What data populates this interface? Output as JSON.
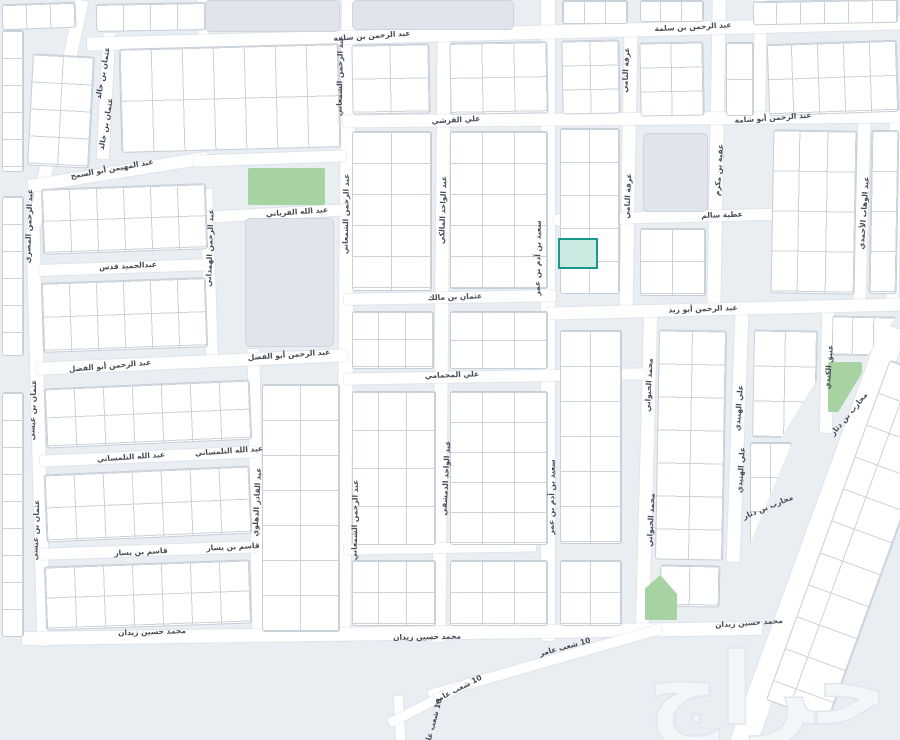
{
  "colors": {
    "background": "#e9eef3",
    "road": "#ffffff",
    "block_fill": "#ffffff",
    "block_border": "#c6ced6",
    "parcel_line": "#ccd3da",
    "landmark": "#dfe5ea",
    "park": "#a6d3a1",
    "highlight_fill": "#cdeae2",
    "highlight_border": "#18998c",
    "label": "#454b53",
    "watermark": "#f3f6f9"
  },
  "watermark": {
    "text": "حراج"
  },
  "highlight_parcel": {
    "x": 558,
    "y": 238,
    "w": 36,
    "h": 27
  },
  "street_labels": [
    {
      "text": "عبد الرحمن بن سلمة",
      "x": 372,
      "y": 36,
      "rot": -4
    },
    {
      "text": "عبد الرحمن بن سلمة",
      "x": 693,
      "y": 27,
      "rot": -3
    },
    {
      "text": "علي القرشي",
      "x": 456,
      "y": 120,
      "rot": -3
    },
    {
      "text": "عبد الرحمن أبو شامة",
      "x": 773,
      "y": 118,
      "rot": -4
    },
    {
      "text": "عبد المهيمن أبو السمح",
      "x": 112,
      "y": 169,
      "rot": -10
    },
    {
      "text": "عبد الله الفرياني",
      "x": 297,
      "y": 212,
      "rot": -4
    },
    {
      "text": "عطية سالم",
      "x": 722,
      "y": 215,
      "rot": -2
    },
    {
      "text": "عبدالحميد قدس",
      "x": 128,
      "y": 266,
      "rot": -3
    },
    {
      "text": "عثمان بن مالك",
      "x": 455,
      "y": 297,
      "rot": -2
    },
    {
      "text": "عبد الرحمن أبو زيد",
      "x": 703,
      "y": 309,
      "rot": -2
    },
    {
      "text": "عبد الرحمن أبو الفضل",
      "x": 110,
      "y": 366,
      "rot": -5
    },
    {
      "text": "عبد الرحمن أبو الفضل",
      "x": 289,
      "y": 355,
      "rot": -4
    },
    {
      "text": "علي المحمامي",
      "x": 452,
      "y": 375,
      "rot": -2
    },
    {
      "text": "عبد الله التلمساني",
      "x": 131,
      "y": 457,
      "rot": -4
    },
    {
      "text": "عبد الله التلمساني",
      "x": 229,
      "y": 451,
      "rot": -4
    },
    {
      "text": "قاسم بن يسار",
      "x": 141,
      "y": 552,
      "rot": -3
    },
    {
      "text": "قاسم بن يسار",
      "x": 233,
      "y": 547,
      "rot": -3
    },
    {
      "text": "محمد حسين زيدان",
      "x": 152,
      "y": 632,
      "rot": -2
    },
    {
      "text": "محمد حسين زيدان",
      "x": 427,
      "y": 637,
      "rot": -1
    },
    {
      "text": "محمد حسين زيدان",
      "x": 749,
      "y": 623,
      "rot": -4
    },
    {
      "text": "10 شعب عامر",
      "x": 565,
      "y": 647,
      "rot": -15
    },
    {
      "text": "10 شعب عامر",
      "x": 458,
      "y": 689,
      "rot": -27
    },
    {
      "text": "10 شعب عامر",
      "x": 433,
      "y": 724,
      "rot": -75
    },
    {
      "text": "عثمان بن خالد",
      "x": 103,
      "y": 73,
      "rot": -80
    },
    {
      "text": "عثمان بن خالد",
      "x": 106,
      "y": 124,
      "rot": -80
    },
    {
      "text": "عبد الرحمن المصري",
      "x": 29,
      "y": 226,
      "rot": -88
    },
    {
      "text": "عثمان بن عيسى",
      "x": 33,
      "y": 410,
      "rot": -88
    },
    {
      "text": "عثمان بن عيسى",
      "x": 36,
      "y": 530,
      "rot": -88
    },
    {
      "text": "عبد الرحمن الهمداني",
      "x": 210,
      "y": 248,
      "rot": -88
    },
    {
      "text": "عبد القادر الدهلوي",
      "x": 257,
      "y": 502,
      "rot": -87
    },
    {
      "text": "عبد الرحمن الشمعاني",
      "x": 340,
      "y": 76,
      "rot": -89
    },
    {
      "text": "عبد الرحمن الشمعاني",
      "x": 346,
      "y": 214,
      "rot": -89
    },
    {
      "text": "عبد الرحمن الشمعاني",
      "x": 355,
      "y": 520,
      "rot": -89
    },
    {
      "text": "عبد الواحد المالكي",
      "x": 443,
      "y": 210,
      "rot": -88
    },
    {
      "text": "عبد الواحد الدمشقي",
      "x": 446,
      "y": 478,
      "rot": -87
    },
    {
      "text": "سعيد بن آدم بن عمر",
      "x": 538,
      "y": 258,
      "rot": -89
    },
    {
      "text": "سعيد بن آدم بن عمر",
      "x": 552,
      "y": 497,
      "rot": -89
    },
    {
      "text": "عرفة النامي",
      "x": 626,
      "y": 70,
      "rot": -87
    },
    {
      "text": "عرفة النامي",
      "x": 628,
      "y": 196,
      "rot": -87
    },
    {
      "text": "عقبة بن مكرم",
      "x": 719,
      "y": 170,
      "rot": -86
    },
    {
      "text": "محمد الحبواني",
      "x": 649,
      "y": 385,
      "rot": -87
    },
    {
      "text": "محمد الحبواني",
      "x": 651,
      "y": 520,
      "rot": -87
    },
    {
      "text": "علي الهنيدي",
      "x": 739,
      "y": 408,
      "rot": -86
    },
    {
      "text": "علي الهنيدي",
      "x": 741,
      "y": 470,
      "rot": -86
    },
    {
      "text": "عتيق الكندي",
      "x": 829,
      "y": 367,
      "rot": -86
    },
    {
      "text": "عبد الوهاب الأحمدي",
      "x": 864,
      "y": 213,
      "rot": -86
    },
    {
      "text": "محارب بن دثار",
      "x": 849,
      "y": 414,
      "rot": -50
    },
    {
      "text": "محارب بن دثار",
      "x": 768,
      "y": 507,
      "rot": -22
    }
  ],
  "geometry": {
    "roads": [
      {
        "x": 57,
        "y": 115,
        "w": 13,
        "h": 235,
        "rot": 12
      },
      {
        "x": 38,
        "y": 437,
        "w": 13,
        "h": 418,
        "rot": -1.5
      },
      {
        "x": 106,
        "y": 96,
        "w": 12,
        "h": 126,
        "rot": 3
      },
      {
        "x": 203,
        "y": 17,
        "w": 10,
        "h": 38,
        "rot": -2
      },
      {
        "x": 209,
        "y": 272,
        "w": 12,
        "h": 167,
        "rot": -2
      },
      {
        "x": 256,
        "y": 495,
        "w": 12,
        "h": 292,
        "rot": -1
      },
      {
        "x": 346,
        "y": 320,
        "w": 14,
        "h": 642,
        "rot": 0.5
      },
      {
        "x": 441,
        "y": 336,
        "w": 13,
        "h": 612,
        "rot": 0.5
      },
      {
        "x": 548,
        "y": 320,
        "w": 14,
        "h": 642,
        "rot": 0
      },
      {
        "x": 628,
        "y": 170,
        "w": 13,
        "h": 287,
        "rot": 1
      },
      {
        "x": 646,
        "y": 472,
        "w": 13,
        "h": 324,
        "rot": 1.5
      },
      {
        "x": 716,
        "y": 157,
        "w": 13,
        "h": 315,
        "rot": 1
      },
      {
        "x": 737,
        "y": 436,
        "w": 13,
        "h": 252,
        "rot": 2
      },
      {
        "x": 760,
        "y": 60,
        "w": 12,
        "h": 122,
        "rot": 1
      },
      {
        "x": 827,
        "y": 372,
        "w": 12,
        "h": 122,
        "rot": 1
      },
      {
        "x": 862,
        "y": 210,
        "w": 12,
        "h": 186,
        "rot": 1.5
      },
      {
        "x": 894,
        "y": 215,
        "w": 12,
        "h": 192,
        "rot": 1
      },
      {
        "x": 399,
        "y": 719,
        "w": 9,
        "h": 46,
        "rot": -3
      },
      {
        "x": 495,
        "y": 33,
        "w": 816,
        "h": 13,
        "rot": -1.5
      },
      {
        "x": 622,
        "y": 119,
        "w": 558,
        "h": 12,
        "rot": -0.5
      },
      {
        "x": 118,
        "y": 172,
        "w": 182,
        "h": 12,
        "rot": -9
      },
      {
        "x": 270,
        "y": 158,
        "w": 152,
        "h": 11,
        "rot": -2
      },
      {
        "x": 276,
        "y": 213,
        "w": 142,
        "h": 11,
        "rot": -3
      },
      {
        "x": 685,
        "y": 216,
        "w": 262,
        "h": 11,
        "rot": -1.5
      },
      {
        "x": 125,
        "y": 267,
        "w": 172,
        "h": 11,
        "rot": -2
      },
      {
        "x": 450,
        "y": 297,
        "w": 212,
        "h": 11,
        "rot": -1
      },
      {
        "x": 725,
        "y": 309,
        "w": 357,
        "h": 12,
        "rot": -1.5
      },
      {
        "x": 192,
        "y": 362,
        "w": 312,
        "h": 12,
        "rot": -2.5
      },
      {
        "x": 495,
        "y": 376,
        "w": 302,
        "h": 11,
        "rot": -1
      },
      {
        "x": 148,
        "y": 456,
        "w": 217,
        "h": 11,
        "rot": -2.5
      },
      {
        "x": 148,
        "y": 550,
        "w": 217,
        "h": 11,
        "rot": -2
      },
      {
        "x": 440,
        "y": 548,
        "w": 192,
        "h": 10,
        "rot": -1
      },
      {
        "x": 392,
        "y": 633,
        "w": 740,
        "h": 13,
        "rot": -0.8
      },
      {
        "x": 817,
        "y": 540,
        "w": 26,
        "h": 452,
        "rot": 20
      },
      {
        "x": 545,
        "y": 662,
        "w": 242,
        "h": 10,
        "rot": -16
      },
      {
        "x": 430,
        "y": 702,
        "w": 92,
        "h": 9,
        "rot": -27
      }
    ],
    "blocks": [
      {
        "x": 96,
        "y": 3,
        "w": 108,
        "h": 26,
        "cw": 27,
        "ch": 30,
        "rot": -1
      },
      {
        "x": 2,
        "y": 3,
        "w": 72,
        "h": 24,
        "cw": 24,
        "ch": 26,
        "rot": -2
      },
      {
        "x": 2,
        "y": 30,
        "w": 20,
        "h": 140,
        "cw": 99,
        "ch": 27
      },
      {
        "x": 2,
        "y": 196,
        "w": 20,
        "h": 158,
        "cw": 99,
        "ch": 27
      },
      {
        "x": 2,
        "y": 392,
        "w": 20,
        "h": 243,
        "cw": 99,
        "ch": 27
      },
      {
        "x": 30,
        "y": 55,
        "w": 60,
        "h": 110,
        "cw": 30,
        "ch": 27,
        "rot": 3
      },
      {
        "x": 120,
        "y": 46,
        "w": 218,
        "h": 102,
        "cw": 31,
        "ch": 51,
        "rot": -1.5
      },
      {
        "x": 42,
        "y": 186,
        "w": 163,
        "h": 64,
        "cw": 27,
        "ch": 31,
        "rot": -2
      },
      {
        "x": 42,
        "y": 280,
        "w": 163,
        "h": 68,
        "cw": 27,
        "ch": 33,
        "rot": -2
      },
      {
        "x": 45,
        "y": 384,
        "w": 204,
        "h": 58,
        "cw": 29,
        "ch": 28,
        "rot": -2.5
      },
      {
        "x": 45,
        "y": 470,
        "w": 204,
        "h": 66,
        "cw": 29,
        "ch": 32,
        "rot": -2.5
      },
      {
        "x": 45,
        "y": 563,
        "w": 204,
        "h": 62,
        "cw": 29,
        "ch": 30,
        "rot": -2
      },
      {
        "x": 262,
        "y": 384,
        "w": 76,
        "h": 246,
        "cw": 38,
        "ch": 35
      },
      {
        "x": 352,
        "y": 44,
        "w": 76,
        "h": 68,
        "cw": 38,
        "ch": 33,
        "rot": -1
      },
      {
        "x": 352,
        "y": 131,
        "w": 78,
        "h": 158,
        "cw": 39,
        "ch": 31
      },
      {
        "x": 352,
        "y": 311,
        "w": 80,
        "h": 56,
        "cw": 27,
        "ch": 27
      },
      {
        "x": 352,
        "y": 391,
        "w": 82,
        "h": 152,
        "cw": 28,
        "ch": 38
      },
      {
        "x": 352,
        "y": 560,
        "w": 82,
        "h": 64,
        "cw": 28,
        "ch": 31
      },
      {
        "x": 450,
        "y": 42,
        "w": 96,
        "h": 70,
        "cw": 32,
        "ch": 34,
        "rot": -1
      },
      {
        "x": 450,
        "y": 131,
        "w": 96,
        "h": 156,
        "cw": 32,
        "ch": 31
      },
      {
        "x": 450,
        "y": 311,
        "w": 96,
        "h": 56,
        "cw": 32,
        "ch": 28
      },
      {
        "x": 450,
        "y": 391,
        "w": 96,
        "h": 152,
        "cw": 32,
        "ch": 30
      },
      {
        "x": 450,
        "y": 560,
        "w": 96,
        "h": 64,
        "cw": 32,
        "ch": 31
      },
      {
        "x": 562,
        "y": 0,
        "w": 64,
        "h": 22,
        "cw": 21,
        "ch": 30
      },
      {
        "x": 640,
        "y": 0,
        "w": 62,
        "h": 20,
        "cw": 21,
        "ch": 30
      },
      {
        "x": 753,
        "y": 0,
        "w": 143,
        "h": 22,
        "cw": 24,
        "ch": 30,
        "rot": -1
      },
      {
        "x": 562,
        "y": 40,
        "w": 56,
        "h": 72,
        "cw": 28,
        "ch": 24,
        "rot": -1
      },
      {
        "x": 560,
        "y": 128,
        "w": 58,
        "h": 164,
        "cw": 29,
        "ch": 33
      },
      {
        "x": 560,
        "y": 330,
        "w": 60,
        "h": 212,
        "cw": 30,
        "ch": 35
      },
      {
        "x": 560,
        "y": 560,
        "w": 60,
        "h": 64,
        "cw": 30,
        "ch": 31
      },
      {
        "x": 640,
        "y": 42,
        "w": 62,
        "h": 72,
        "cw": 31,
        "ch": 24,
        "rot": -1
      },
      {
        "x": 726,
        "y": 42,
        "w": 26,
        "h": 72,
        "cw": 26,
        "ch": 36
      },
      {
        "x": 640,
        "y": 228,
        "w": 64,
        "h": 66,
        "cw": 32,
        "ch": 32
      },
      {
        "x": 657,
        "y": 330,
        "w": 66,
        "h": 228,
        "cw": 33,
        "ch": 33,
        "rot": 1
      },
      {
        "x": 660,
        "y": 565,
        "w": 58,
        "h": 40,
        "cw": 29,
        "ch": 38,
        "rot": 1
      },
      {
        "x": 768,
        "y": 42,
        "w": 128,
        "h": 70,
        "cw": 26,
        "ch": 34,
        "rot": -2
      },
      {
        "x": 772,
        "y": 130,
        "w": 82,
        "h": 162,
        "cw": 28,
        "ch": 40,
        "rot": 1
      },
      {
        "x": 870,
        "y": 130,
        "w": 26,
        "h": 162,
        "cw": 25,
        "ch": 40,
        "rot": 1
      },
      {
        "x": 753,
        "y": 330,
        "w": 62,
        "h": 106,
        "cw": 31,
        "ch": 35,
        "rot": 1,
        "clip": "polygon(0 0,100% 0,100% 45%,45% 100%,0 100%)"
      },
      {
        "x": 832,
        "y": 316,
        "w": 62,
        "h": 38,
        "cw": 21,
        "ch": 37,
        "rot": 1,
        "clip": "polygon(0 0,100% 0,55% 100%,0 100%)"
      },
      {
        "x": 750,
        "y": 442,
        "w": 40,
        "h": 100,
        "cw": 20,
        "ch": 34,
        "clip": "polygon(0 0,100% 0,0 100%)"
      },
      {
        "x": 826,
        "y": 360,
        "w": 64,
        "h": 360,
        "cw": 40,
        "ch": 34,
        "rot": 20
      }
    ],
    "landmarks": [
      {
        "x": 205,
        "y": 0,
        "w": 133,
        "h": 30
      },
      {
        "x": 352,
        "y": 0,
        "w": 160,
        "h": 28
      },
      {
        "x": 245,
        "y": 218,
        "w": 87,
        "h": 127
      },
      {
        "x": 643,
        "y": 133,
        "w": 63,
        "h": 77
      }
    ],
    "parks": [
      {
        "x": 248,
        "y": 168,
        "w": 77,
        "h": 37
      },
      {
        "x": 828,
        "y": 362,
        "w": 34,
        "h": 50,
        "clip": "polygon(0 0,100% 0,100% 22%,30% 100%,0 100%)"
      },
      {
        "x": 645,
        "y": 575,
        "w": 32,
        "h": 45,
        "clip": "polygon(48% 0,100% 42%,100% 100%,0 100%,0 30%)"
      }
    ]
  }
}
